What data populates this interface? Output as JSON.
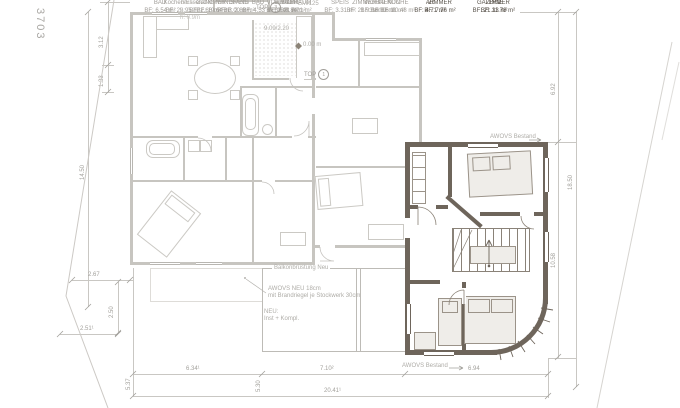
{
  "markers": {
    "parcel": "3703",
    "level": "0.00 m",
    "stair_note": "9.09/2.20",
    "window_note": "EM/125"
  },
  "badges": {
    "top3": {
      "label": "TOP",
      "number": "3"
    },
    "top1": {
      "label": "TOP",
      "number": "1"
    }
  },
  "rooms": {
    "windfang": {
      "name": "WINDFANG",
      "area": "BF: 3.00 m²"
    },
    "kochen_essen": {
      "name": "Kochen/Essen",
      "area": "BF: 29.95 m²"
    },
    "stgh": {
      "name": "STGH",
      "area": "BF: 4.84 m²"
    },
    "speis_og": {
      "name": "SPEIS",
      "area": "BF: 3.31 m²"
    },
    "kueche": {
      "name": "KÜCHE",
      "area": "BF: 10.48 m²"
    },
    "bad_top": {
      "name": "BAD",
      "area": "BF: 4.53 m²"
    },
    "vorraum_top": {
      "name": "VORRAUM",
      "area": "BF: 7.21 m²"
    },
    "wohnen": {
      "name": "WOHNEN",
      "area": "BF: 16.33 m²"
    },
    "gang": {
      "name": "GANG",
      "area": "BF: 2.66 m²"
    },
    "bad_mid": {
      "name": "BAD",
      "area": "BF: 6.54 m²"
    },
    "speis_mid": {
      "name": "SPEIS",
      "area": "BF: 2.82 m²"
    },
    "vorraum_mid": {
      "name": "VORRAUM",
      "area": "BF: 3.43 m²"
    },
    "zimmer_west": {
      "name": "ZIMMER",
      "area": "BF: 19.64 m²"
    },
    "buero": {
      "name": "BÜRO",
      "area": "BF: 8.21 m²"
    },
    "zimmer_mitte": {
      "name": "ZIMMER",
      "area": "BF: 21.93 m²"
    },
    "balkon": {
      "name": "BALKON",
      "area": "BF: 16.11 m²"
    },
    "balkon_alt": {
      "name": "Balkon",
      "line2": "B: 0.2m",
      "line3": "h: 0.9m"
    },
    "ar": {
      "name": "AR",
      "area": "BF: 4.71 m²"
    },
    "zimmer_neu_nord": {
      "name": "ZIMMER",
      "area": "BF: 11.78 m²"
    },
    "galerie": {
      "name": "GALERIE",
      "area": "BF: 21.33 m²"
    },
    "zimmer_neu_sued": {
      "name": "ZIMMER",
      "area": "BF: 7.76 m²"
    }
  },
  "annotations": {
    "awovs_bestand": "AWOVS Bestand",
    "bruestung": "Balkonbrüstung Neu",
    "awovs_neu_line1": "AWOVS NEU 18cm",
    "awovs_neu_line2": "mit Brandriegel je Stockwerk 30cm",
    "neu_line1": "NEU:",
    "neu_line2": "Inst + Kompl."
  },
  "dimensions": {
    "d_3_12": "3.12",
    "d_1_33": "1.33",
    "d_14_50": "14.50",
    "d_2_67": "2.67",
    "d_2_50": "2.50",
    "d_2_51": "2.51¹",
    "d_5_37": "5.37",
    "d_6_34": "6.34¹",
    "d_5_30": "5.30",
    "d_7_10": "7.10²",
    "d_20_41": "20.41¹",
    "d_6_94": "6.94",
    "d_6_92": "6.92",
    "d_10_58": "10.58",
    "d_18_50": "18.50"
  },
  "colors": {
    "existing_wall": "#c7c5c0",
    "new_wall": "#6e655b",
    "text_existing": "#a19e99",
    "text_new": "#5a544c",
    "dimension": "#a3a19c"
  }
}
